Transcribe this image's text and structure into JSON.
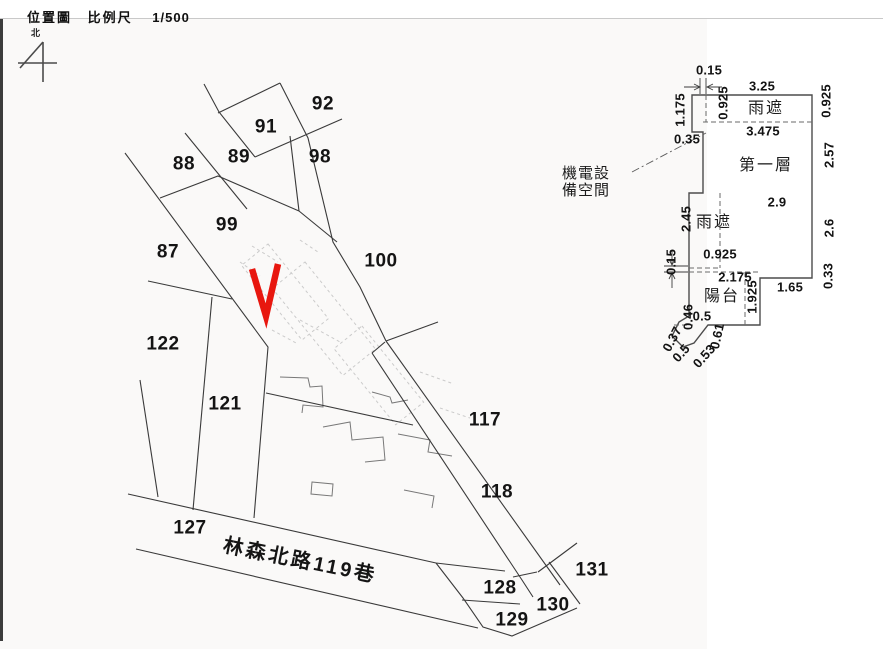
{
  "header": {
    "title": "位置圖",
    "scale_label": "比例尺",
    "scale_value": "1/500",
    "north_label": "北"
  },
  "map": {
    "street_label": "林森北路119巷",
    "marker_color": "#e8170f",
    "parcels": [
      {
        "label": "92",
        "x": 323,
        "y": 104
      },
      {
        "label": "91",
        "x": 266,
        "y": 127
      },
      {
        "label": "89",
        "x": 239,
        "y": 157
      },
      {
        "label": "88",
        "x": 184,
        "y": 164
      },
      {
        "label": "98",
        "x": 320,
        "y": 157
      },
      {
        "label": "99",
        "x": 227,
        "y": 225
      },
      {
        "label": "87",
        "x": 168,
        "y": 252
      },
      {
        "label": "100",
        "x": 381,
        "y": 261
      },
      {
        "label": "122",
        "x": 163,
        "y": 344
      },
      {
        "label": "121",
        "x": 225,
        "y": 404
      },
      {
        "label": "117",
        "x": 485,
        "y": 420
      },
      {
        "label": "118",
        "x": 497,
        "y": 492
      },
      {
        "label": "127",
        "x": 190,
        "y": 528
      },
      {
        "label": "131",
        "x": 592,
        "y": 570
      },
      {
        "label": "128",
        "x": 500,
        "y": 588
      },
      {
        "label": "130",
        "x": 553,
        "y": 605
      },
      {
        "label": "129",
        "x": 512,
        "y": 620
      }
    ]
  },
  "floor_plan": {
    "rooms": [
      {
        "text": "雨遮",
        "x": 766,
        "y": 109
      },
      {
        "text": "第一層",
        "x": 766,
        "y": 166
      },
      {
        "text": "雨遮",
        "x": 714,
        "y": 223
      },
      {
        "text": "陽台",
        "x": 722,
        "y": 297
      }
    ],
    "annotation": {
      "line1": "機電設",
      "line2": "備空間"
    },
    "dimensions": [
      {
        "text": "0.15",
        "x": 709,
        "y": 70,
        "rot": 0
      },
      {
        "text": "3.25",
        "x": 762,
        "y": 86,
        "rot": 0
      },
      {
        "text": "0.925",
        "x": 723,
        "y": 103,
        "rot": -90
      },
      {
        "text": "0.925",
        "x": 826,
        "y": 101,
        "rot": -90
      },
      {
        "text": "1.175",
        "x": 680,
        "y": 110,
        "rot": -90
      },
      {
        "text": "3.475",
        "x": 763,
        "y": 131,
        "rot": 0
      },
      {
        "text": "0.35",
        "x": 687,
        "y": 139,
        "rot": 0
      },
      {
        "text": "2.57",
        "x": 829,
        "y": 155,
        "rot": -90
      },
      {
        "text": "2.9",
        "x": 777,
        "y": 202,
        "rot": 0
      },
      {
        "text": "2.6",
        "x": 829,
        "y": 228,
        "rot": -90
      },
      {
        "text": "2.45",
        "x": 686,
        "y": 219,
        "rot": -90
      },
      {
        "text": "0.925",
        "x": 720,
        "y": 254,
        "rot": 0
      },
      {
        "text": "0.15",
        "x": 671,
        "y": 262,
        "rot": -90
      },
      {
        "text": "2.175",
        "x": 735,
        "y": 277,
        "rot": 0
      },
      {
        "text": "1.925",
        "x": 752,
        "y": 297,
        "rot": -90
      },
      {
        "text": "1.65",
        "x": 790,
        "y": 287,
        "rot": 0
      },
      {
        "text": "0.33",
        "x": 828,
        "y": 276,
        "rot": -90
      },
      {
        "text": "0.46",
        "x": 688,
        "y": 317,
        "rot": -90
      },
      {
        "text": "0.5",
        "x": 702,
        "y": 316,
        "rot": 0
      },
      {
        "text": "0.37",
        "x": 672,
        "y": 339,
        "rot": -62
      },
      {
        "text": "0.5",
        "x": 681,
        "y": 353,
        "rot": -48
      },
      {
        "text": "0.53",
        "x": 704,
        "y": 356,
        "rot": -48
      },
      {
        "text": "0.61",
        "x": 717,
        "y": 336,
        "rot": -78
      }
    ]
  }
}
